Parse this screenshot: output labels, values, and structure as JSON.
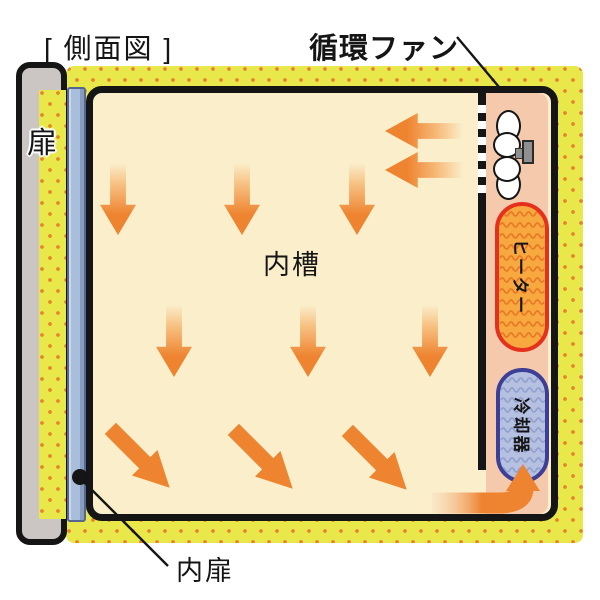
{
  "diagram": {
    "title": "[ 側面図 ]",
    "labels": {
      "circulation_fan": "循環ファン",
      "door": "扉",
      "inner_tank": "内槽",
      "heater": "ヒーター",
      "cooler": "冷却器",
      "inner_door": "内扉"
    },
    "airflow": {
      "arrow_groups": [
        {
          "direction": "left",
          "count": 2,
          "location": "top-right, air blown from circulation fan into inner tank"
        },
        {
          "direction": "down",
          "count": 3,
          "location": "upper row inside inner tank"
        },
        {
          "direction": "down",
          "count": 3,
          "location": "middle row inside inner tank"
        },
        {
          "direction": "down-right",
          "count": 3,
          "location": "lower row inside inner tank"
        },
        {
          "direction": "right-then-up",
          "count": 1,
          "location": "bottom-right, air returning up into heater/cooler compartment"
        }
      ]
    },
    "colors": {
      "insulation_yellow": "#e9e84b",
      "insulation_dot": "#e4862e",
      "inner_tank_cream": "#faeecb",
      "compartment_salmon": "#f5c9ab",
      "arrow_orange": "#ee8330",
      "heater_fill": "#f7a93f",
      "heater_border": "#e5301d",
      "heater_wave": "#e87a28",
      "cooler_fill": "#b6c0e1",
      "cooler_border": "#3d3f96",
      "cooler_wave": "#93a1cf",
      "door_gray": "#cbc5c3",
      "inner_door_blue": "#a9bedb",
      "inner_door_border": "#55678e",
      "outline_black": "#151515",
      "fan_motor_gray": "#8f8f8f"
    }
  }
}
